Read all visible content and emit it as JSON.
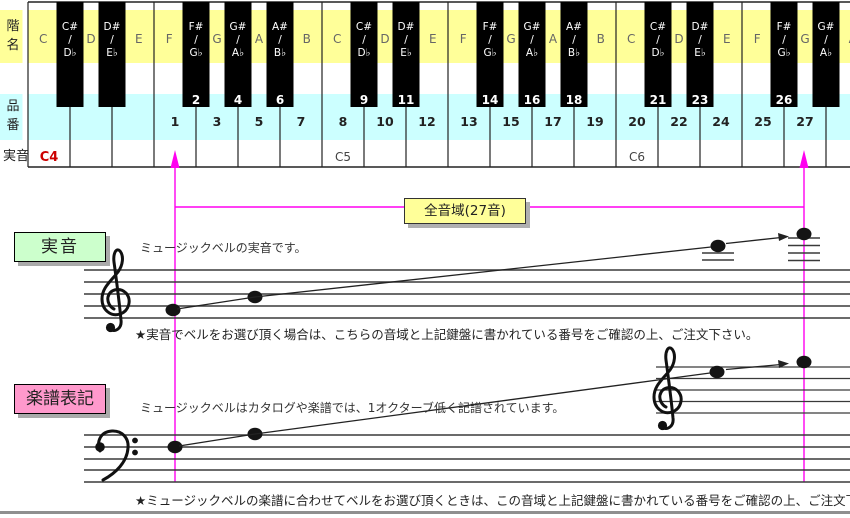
{
  "keyboard": {
    "row_labels": {
      "scale": "階名",
      "product": "品番",
      "pitch": "実音"
    },
    "white_keys": [
      {
        "label": "C",
        "number": "",
        "pitch": "C4"
      },
      {
        "label": "D",
        "number": "",
        "pitch": ""
      },
      {
        "label": "E",
        "number": "",
        "pitch": ""
      },
      {
        "label": "F",
        "number": "1",
        "pitch": ""
      },
      {
        "label": "G",
        "number": "3",
        "pitch": ""
      },
      {
        "label": "A",
        "number": "5",
        "pitch": ""
      },
      {
        "label": "B",
        "number": "7",
        "pitch": ""
      },
      {
        "label": "C",
        "number": "8",
        "pitch": "C5"
      },
      {
        "label": "D",
        "number": "10",
        "pitch": ""
      },
      {
        "label": "E",
        "number": "12",
        "pitch": ""
      },
      {
        "label": "F",
        "number": "13",
        "pitch": ""
      },
      {
        "label": "G",
        "number": "15",
        "pitch": ""
      },
      {
        "label": "A",
        "number": "17",
        "pitch": ""
      },
      {
        "label": "B",
        "number": "19",
        "pitch": ""
      },
      {
        "label": "C",
        "number": "20",
        "pitch": "C6"
      },
      {
        "label": "D",
        "number": "22",
        "pitch": ""
      },
      {
        "label": "E",
        "number": "24",
        "pitch": ""
      },
      {
        "label": "F",
        "number": "25",
        "pitch": ""
      },
      {
        "label": "G",
        "number": "27",
        "pitch": ""
      },
      {
        "label": "A",
        "number": "",
        "pitch": ""
      }
    ],
    "black_keys": [
      {
        "position": 1,
        "sharp": "C#",
        "flat": "D♭",
        "number": ""
      },
      {
        "position": 2,
        "sharp": "D#",
        "flat": "E♭",
        "number": ""
      },
      {
        "position": 4,
        "sharp": "F#",
        "flat": "G♭",
        "number": "2"
      },
      {
        "position": 5,
        "sharp": "G#",
        "flat": "A♭",
        "number": "4"
      },
      {
        "position": 6,
        "sharp": "A#",
        "flat": "B♭",
        "number": "6"
      },
      {
        "position": 8,
        "sharp": "C#",
        "flat": "D♭",
        "number": "9"
      },
      {
        "position": 9,
        "sharp": "D#",
        "flat": "E♭",
        "number": "11"
      },
      {
        "position": 11,
        "sharp": "F#",
        "flat": "G♭",
        "number": "14"
      },
      {
        "position": 12,
        "sharp": "G#",
        "flat": "A♭",
        "number": "16"
      },
      {
        "position": 13,
        "sharp": "A#",
        "flat": "B♭",
        "number": "18"
      },
      {
        "position": 15,
        "sharp": "C#",
        "flat": "D♭",
        "number": "21"
      },
      {
        "position": 16,
        "sharp": "D#",
        "flat": "E♭",
        "number": "23"
      },
      {
        "position": 18,
        "sharp": "F#",
        "flat": "G♭",
        "number": "26"
      },
      {
        "position": 19,
        "sharp": "G#",
        "flat": "A♭",
        "number": ""
      }
    ]
  },
  "range": {
    "label": "全音域(27音)"
  },
  "sections": {
    "actual": {
      "title": "実音",
      "desc": "ミュージックベルの実音です。",
      "note": "★実音でベルをお選び頂く場合は、こちらの音域と上記鍵盤に書かれている番号をご確認の上、ご注文下さい。"
    },
    "score": {
      "title": "楽譜表記",
      "desc": "ミュージックベルはカタログや楽譜では、1オクターブ低く記譜されています。",
      "note": "★ミュージックベルの楽譜に合わせてベルをお選び頂くときは、この音域と上記鍵盤に書かれている番号をご確認の上、ご注文下さい。"
    }
  },
  "colors": {
    "scale_band": "#FFFF99",
    "product_band": "#CCFFFF",
    "actual_tag": "#CCFFCC",
    "score_tag": "#FF99CC",
    "range_box": "#FFFF99",
    "pitch_c4": "#CC0000",
    "guide_line": "#FF00F0"
  }
}
